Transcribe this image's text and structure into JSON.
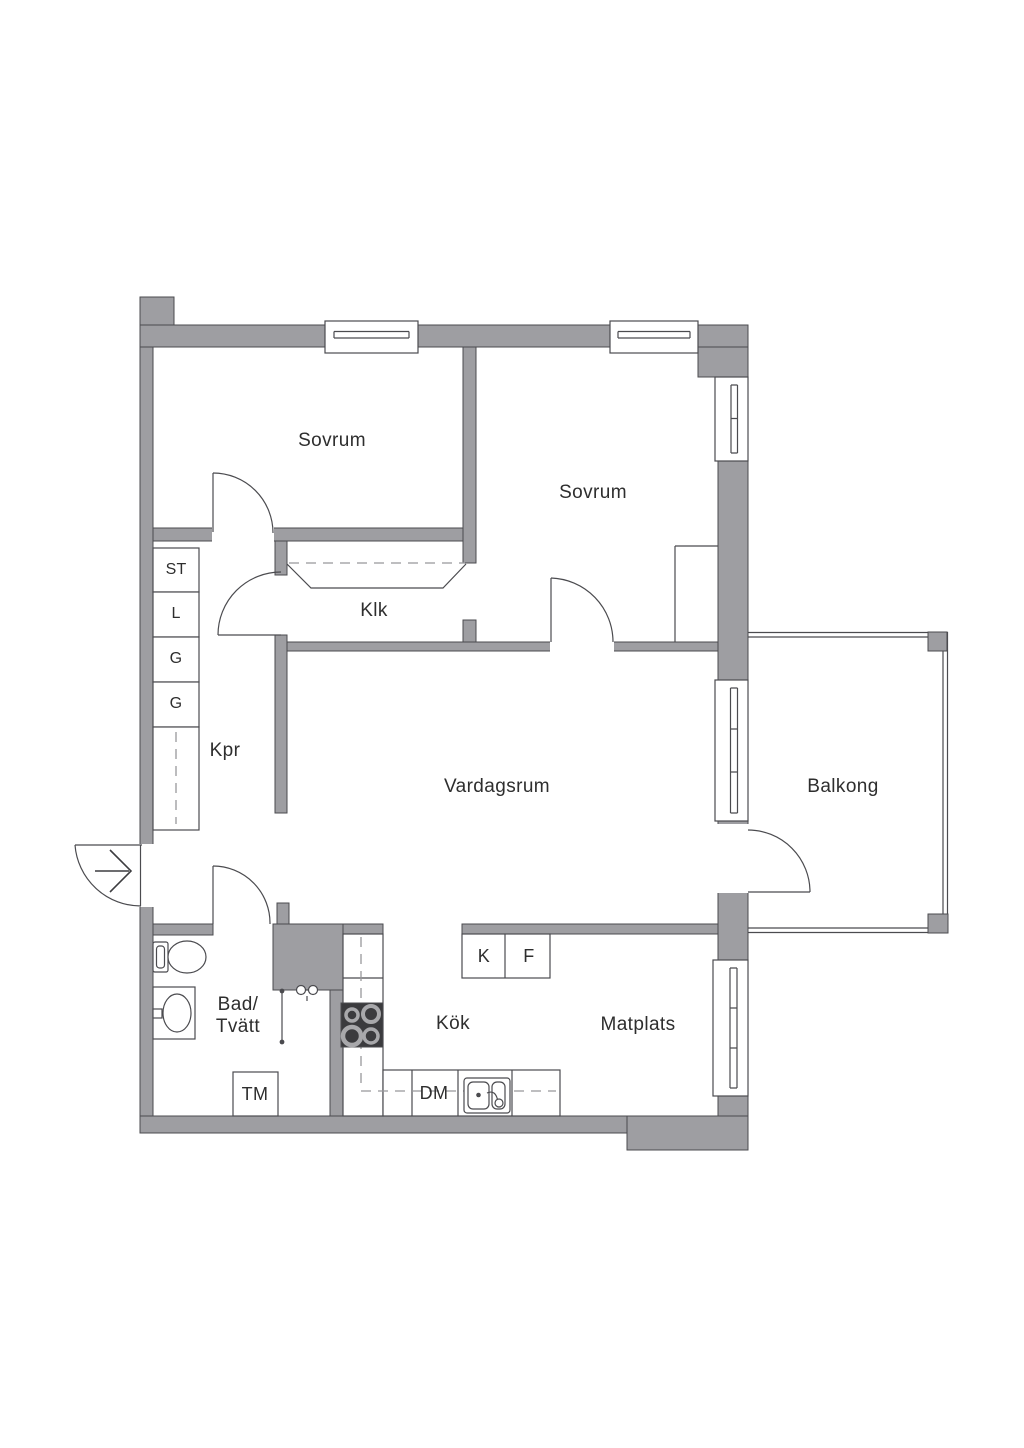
{
  "title": "Apartment floor plan",
  "colors": {
    "wall": "#9e9ea2",
    "line": "#4b4b4f",
    "text": "#2e2e2e",
    "dash": "#97979b",
    "stove": "#3b3b3e"
  },
  "labels": {
    "bedroom1": "Sovrum",
    "bedroom2": "Sovrum",
    "walk_in_closet": "Klk",
    "hallway": "Kpr",
    "living_room": "Vardagsrum",
    "balcony": "Balkong",
    "bathroom_line1": "Bad/",
    "bathroom_line2": "Tvätt",
    "kitchen": "Kök",
    "dining": "Matplats",
    "closet_st": "ST",
    "closet_l": "L",
    "closet_g1": "G",
    "closet_g2": "G",
    "washing_machine": "TM",
    "dishwasher": "DM",
    "fridge": "K",
    "freezer": "F"
  }
}
